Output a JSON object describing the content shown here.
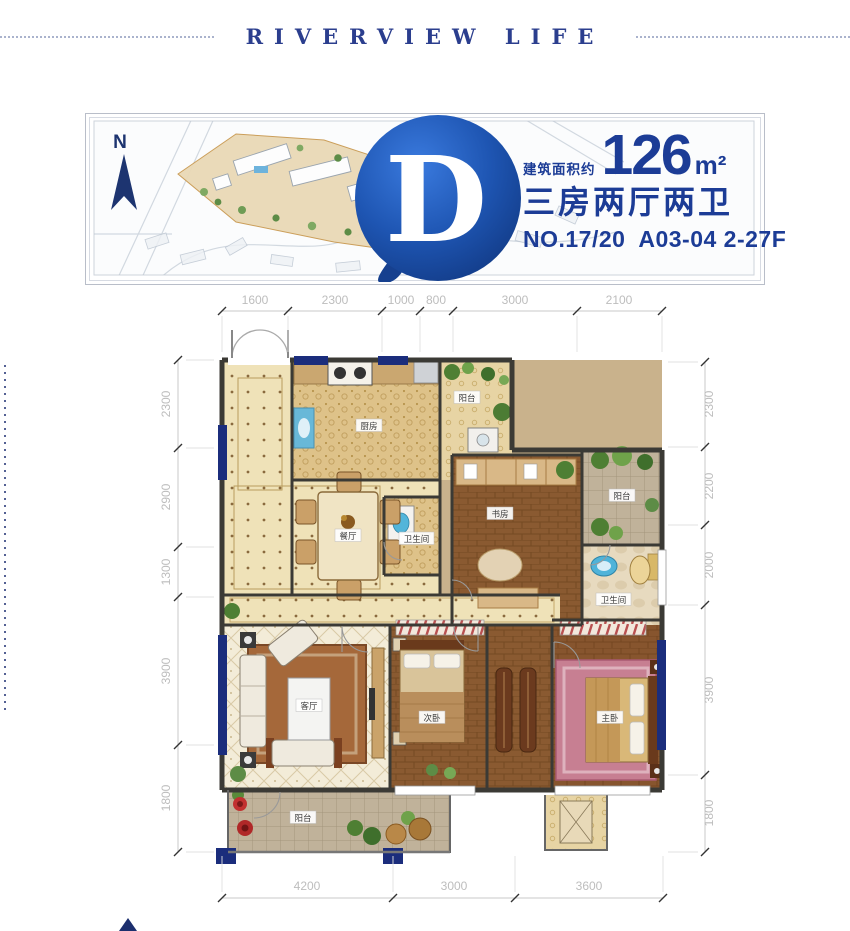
{
  "header": {
    "title": "RIVERVIEW LIFE"
  },
  "banner": {
    "compass": "N",
    "logo_letter": "D",
    "area_label": "建筑面积约",
    "area_value": "126",
    "area_unit": "m²",
    "layout": "三房两厅两卫",
    "number": "NO.17/20",
    "code": "A03-04 2-27F",
    "accent_color": "#1c3c96",
    "logo_color": "#1e55b2"
  },
  "plan": {
    "dims": {
      "top": [
        "1600",
        "2300",
        "1000",
        "800",
        "3000",
        "2100"
      ],
      "left": [
        "2300",
        "2900",
        "1300",
        "3900",
        "1800"
      ],
      "right": [
        "2300",
        "2200",
        "2000",
        "3900",
        "1800"
      ],
      "bottom": [
        "4200",
        "3000",
        "3600"
      ]
    },
    "rooms": {
      "kitchen": "厨房",
      "balcony_top": "阳台",
      "study": "书房",
      "balcony_right": "阳台",
      "dining": "餐厅",
      "bath": "卫生间",
      "bath_master": "卫生间",
      "living": "客厅",
      "bedroom_second": "次卧",
      "bedroom_master": "主卧",
      "balcony_bottom": "阳台"
    },
    "wall_color": "#3b3a35",
    "window_color": "#1b2d7c",
    "dim_text_color": "#bdbdbd"
  }
}
